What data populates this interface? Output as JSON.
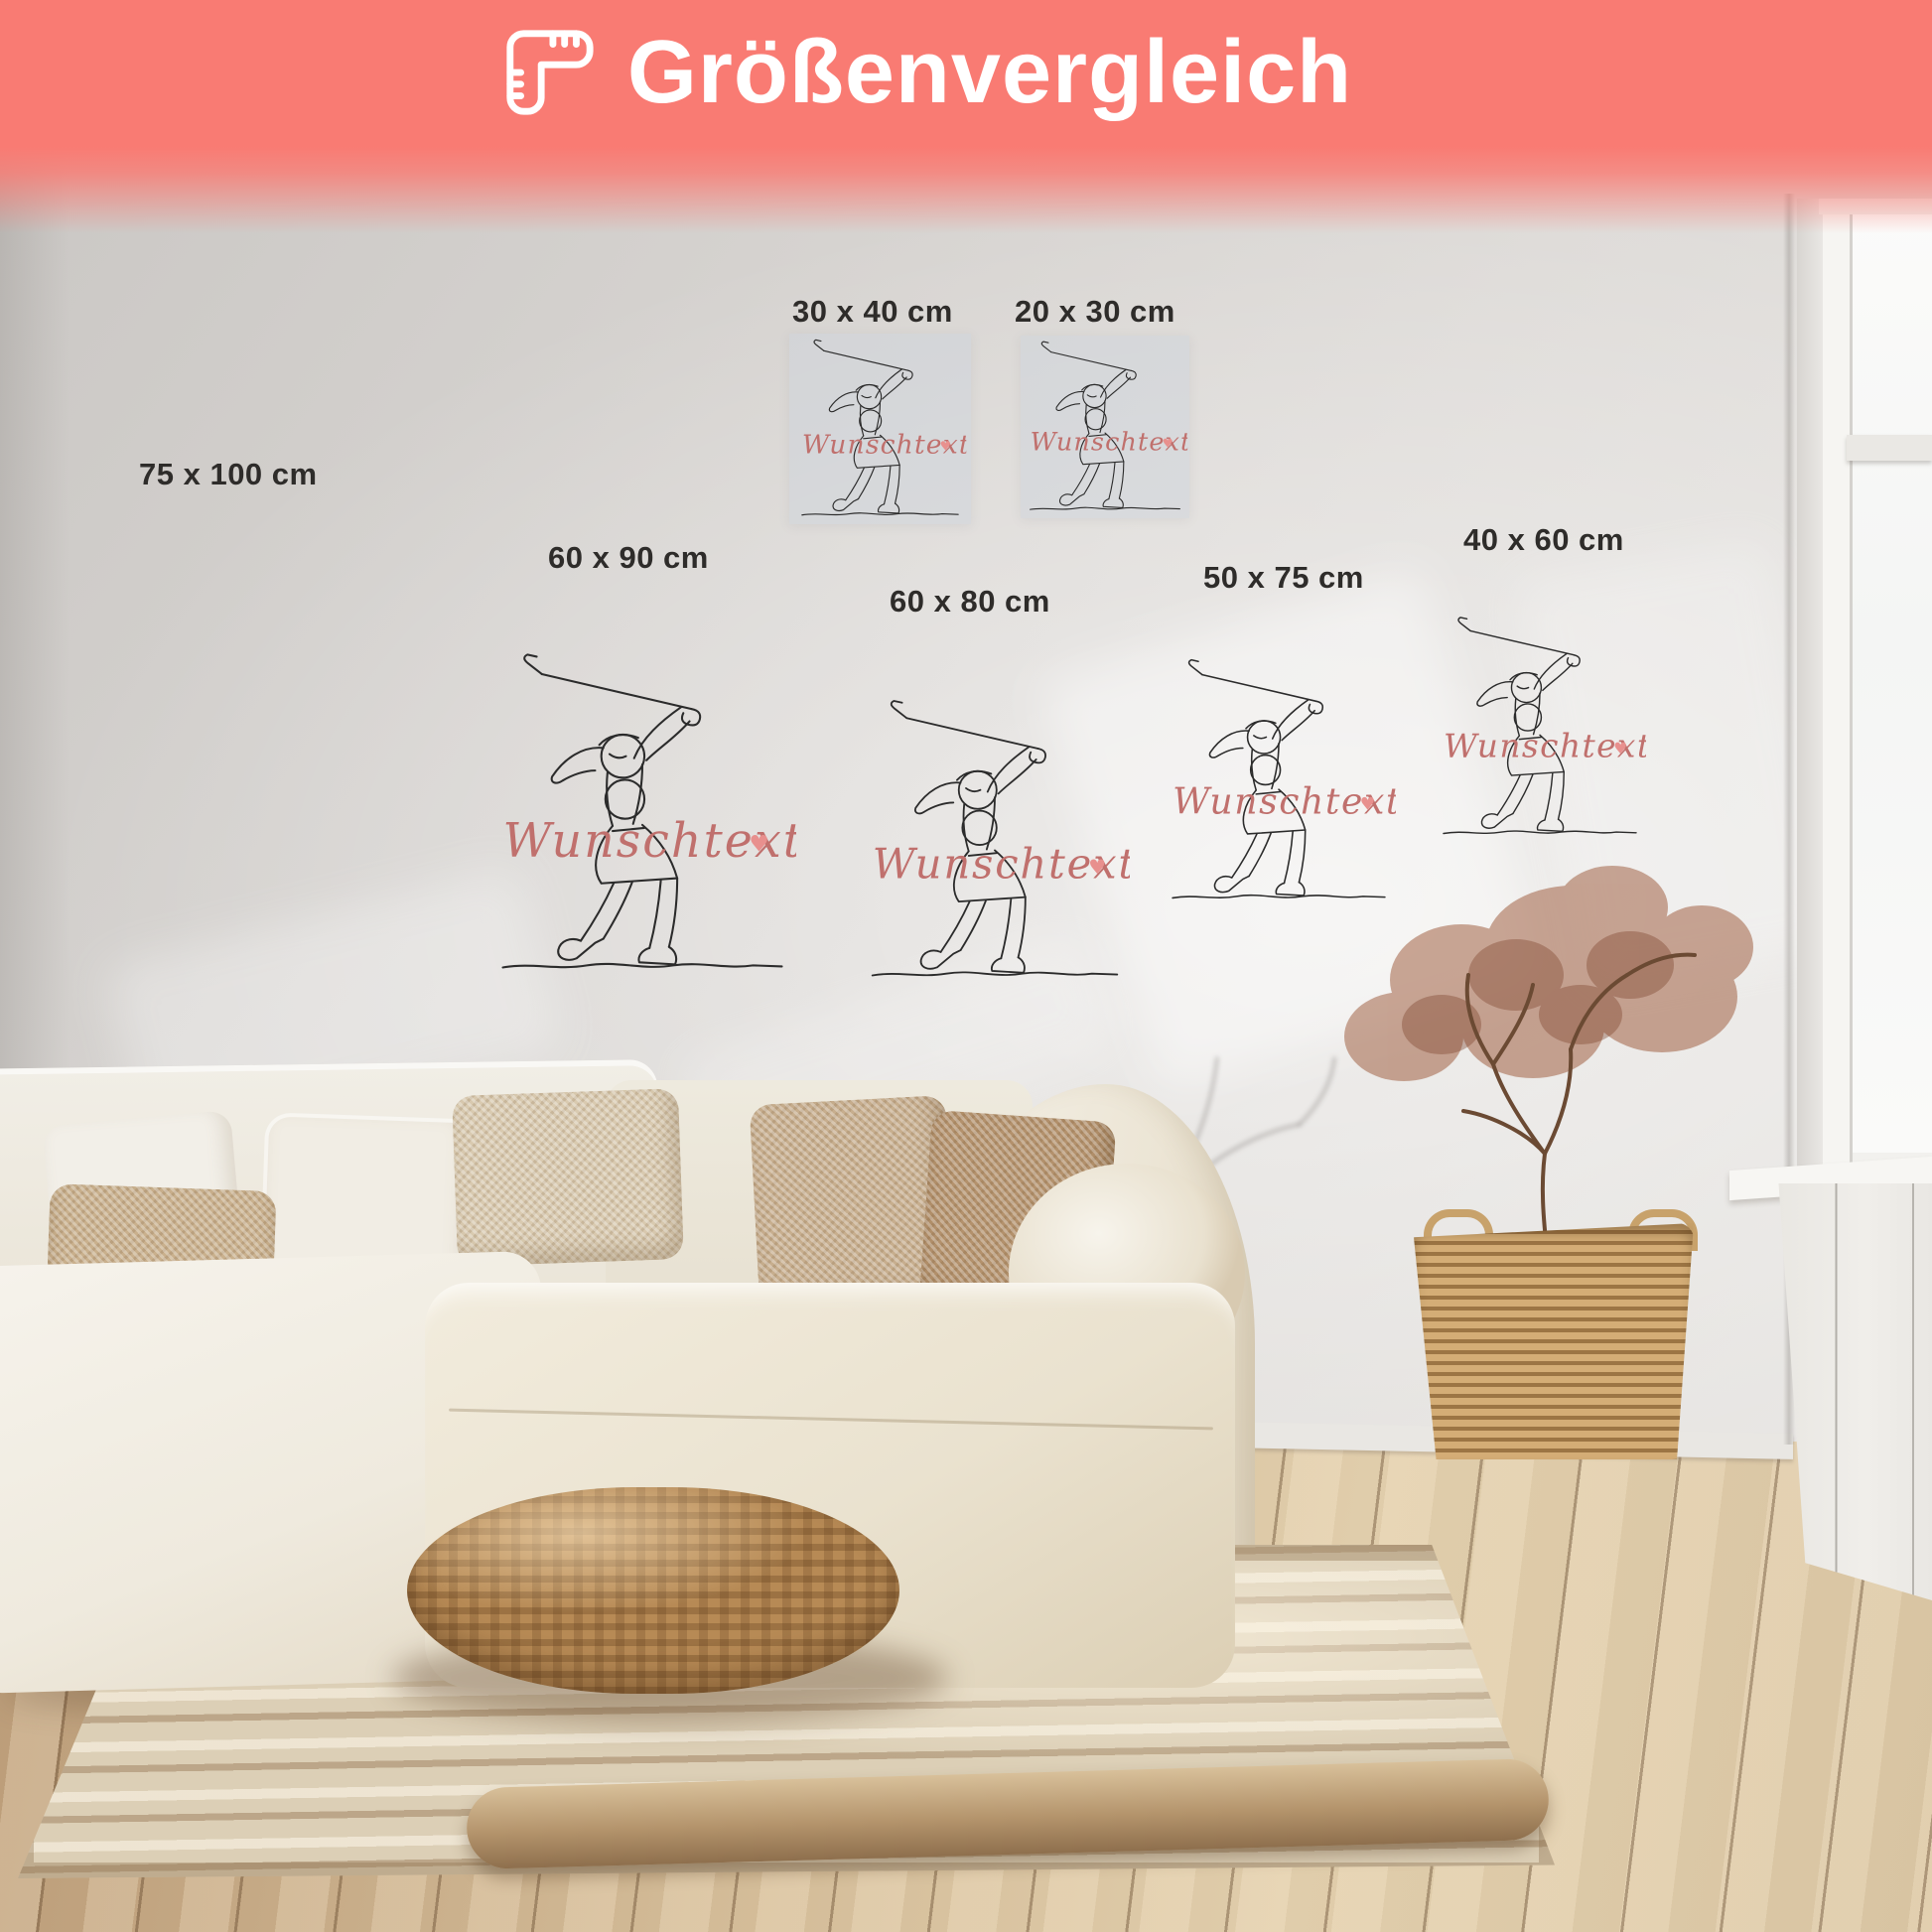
{
  "banner": {
    "title": "Größenvergleich",
    "bg_color": "#f97b73",
    "text_color": "#ffffff",
    "icon": "folding-ruler-icon"
  },
  "sizes": [
    {
      "label": "75 x 100 cm"
    },
    {
      "label": "30 x 40 cm"
    },
    {
      "label": "20 x 30 cm"
    },
    {
      "label": "60 x 90 cm"
    },
    {
      "label": "60 x 80 cm"
    },
    {
      "label": "50 x 75 cm"
    },
    {
      "label": "40 x 60 cm"
    }
  ],
  "poster": {
    "subject": "golfer-one-line-art",
    "custom_text": "Wunschtext",
    "heart_char": "♥",
    "script_color": "#c0706d",
    "heart_color": "#e8908e",
    "line_color": "#2b2b2b"
  },
  "scene": {
    "wall_color": "#d6d3d0",
    "floor_color": "#d2ba96",
    "sofa_color": "#f0ebe0",
    "rug_color": "#dccfb6",
    "pouf_color": "#b78a55",
    "basket_color": "#c8a26b",
    "plant_foliage_color": "#9a5535"
  }
}
